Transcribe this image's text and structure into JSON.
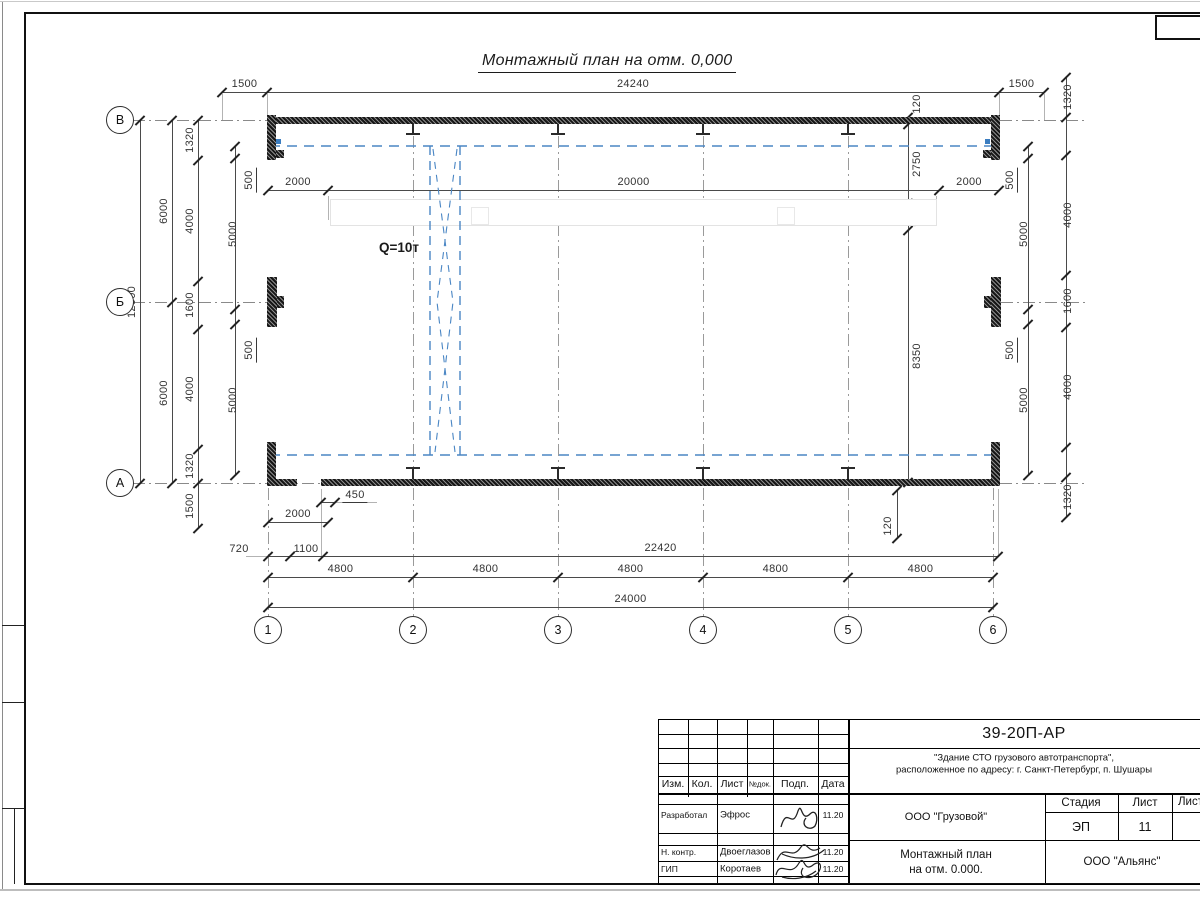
{
  "drawing": {
    "title": "Монтажный план на отм. 0,000",
    "crane_label": "Q=10т"
  },
  "axes": {
    "row_labels": [
      "В",
      "Б",
      "А"
    ],
    "row_x": 120,
    "row_ys": [
      120,
      302,
      483
    ],
    "col_labels": [
      "1",
      "2",
      "3",
      "4",
      "5",
      "6"
    ],
    "col_xs": [
      268,
      413,
      558,
      703,
      848,
      993
    ],
    "col_y": 630
  },
  "dims": {
    "h_chains": [
      {
        "y": 92,
        "pts": [
          222,
          267,
          999,
          1044
        ],
        "labels": [
          "1500",
          "24240",
          "1500"
        ]
      },
      {
        "y": 190,
        "pts": [
          268,
          328,
          939,
          999
        ],
        "labels": [
          "2000",
          "20000",
          "2000"
        ]
      },
      {
        "y": 502,
        "pts": [
          321,
          335
        ],
        "labels": [
          ""
        ]
      },
      {
        "y": 522,
        "pts": [
          268,
          328
        ],
        "labels": [
          "2000"
        ]
      },
      {
        "y": 556,
        "pts": [
          268,
          290,
          323,
          998
        ],
        "labels": [
          "",
          "",
          "22420"
        ]
      },
      {
        "y": 577,
        "pts": [
          268,
          413,
          558,
          703,
          848,
          993
        ],
        "labels": [
          "4800",
          "4800",
          "4800",
          "4800",
          "4800"
        ]
      },
      {
        "y": 607,
        "pts": [
          268,
          993
        ],
        "labels": [
          "24000"
        ]
      }
    ],
    "v_chains": [
      {
        "x": 140,
        "ls": -8,
        "pts": [
          120,
          483
        ],
        "labels": [
          "12000"
        ]
      },
      {
        "x": 172,
        "ls": -8,
        "pts": [
          120,
          302,
          483
        ],
        "labels": [
          "6000",
          "6000"
        ]
      },
      {
        "x": 198,
        "ls": -8,
        "pts": [
          120,
          160,
          281,
          329,
          449,
          483,
          528
        ],
        "labels": [
          "1320",
          "4000",
          "1600",
          "4000",
          "1320",
          "1500"
        ]
      },
      {
        "x": 235,
        "ls": -2,
        "pts": [
          146,
          158,
          309,
          324,
          475
        ],
        "labels": [
          "",
          "5000",
          "",
          "5000"
        ]
      },
      {
        "x": 1028,
        "ls": -4,
        "pts": [
          146,
          158,
          309,
          324,
          475
        ],
        "labels": [
          "",
          "5000",
          "",
          "5000"
        ]
      },
      {
        "x": 1066,
        "ls": 2,
        "pts": [
          77,
          117,
          155,
          275,
          327,
          447,
          477,
          517
        ],
        "labels": [
          "1320",
          "",
          "4000",
          "1600",
          "4000",
          "",
          "1320"
        ]
      },
      {
        "x": 908,
        "ls": 9,
        "pts": [
          117,
          124,
          203,
          230,
          482
        ],
        "labels": [
          "",
          "2750",
          "900",
          "8350"
        ]
      },
      {
        "x": 897,
        "ls": 0,
        "pts": [
          490,
          538
        ],
        "labels": [
          ""
        ]
      }
    ],
    "free_labels": [
      {
        "x": 355,
        "y": 496,
        "t": "450",
        "u": true
      },
      {
        "x": 239,
        "y": 549,
        "t": "720"
      },
      {
        "x": 306,
        "y": 549,
        "t": "1100"
      },
      {
        "x": 250,
        "y": 180,
        "t": "500",
        "r": true,
        "u": true
      },
      {
        "x": 250,
        "y": 350,
        "t": "500",
        "r": true,
        "u": true
      },
      {
        "x": 1011,
        "y": 180,
        "t": "500",
        "r": true,
        "u": true
      },
      {
        "x": 1011,
        "y": 350,
        "t": "500",
        "r": true,
        "u": true
      },
      {
        "x": 917,
        "y": 104,
        "t": "120",
        "r": true
      },
      {
        "x": 888,
        "y": 526,
        "t": "120",
        "r": true
      }
    ],
    "xlines": [
      {
        "x": 222,
        "y": 94,
        "h": 26
      },
      {
        "x": 267,
        "y": 94,
        "h": 21
      },
      {
        "x": 999,
        "y": 94,
        "h": 21
      },
      {
        "x": 1044,
        "y": 94,
        "h": 26
      },
      {
        "x": 321,
        "y": 489,
        "h": 67
      },
      {
        "x": 998,
        "y": 489,
        "h": 67
      },
      {
        "x": 246,
        "y": 556,
        "w": 22
      },
      {
        "x": 335,
        "y": 502,
        "w": 42
      },
      {
        "x": 936,
        "y": 196,
        "h": 24
      },
      {
        "x": 328,
        "y": 196,
        "h": 24
      }
    ],
    "gridlines": [
      {
        "x": 133,
        "y": 120,
        "w": 135
      },
      {
        "x": 133,
        "y": 302,
        "w": 134
      },
      {
        "x": 133,
        "y": 483,
        "w": 135
      },
      {
        "x": 1000,
        "y": 120,
        "w": 85
      },
      {
        "x": 1001,
        "y": 302,
        "w": 84
      },
      {
        "x": 1000,
        "y": 483,
        "w": 85
      },
      {
        "x": 280,
        "y": 483,
        "w": 40
      },
      {
        "x": 268,
        "y": 488,
        "h": 128
      },
      {
        "x": 993,
        "y": 488,
        "h": 128
      },
      {
        "x": 413,
        "y": 136,
        "h": 480
      },
      {
        "x": 558,
        "y": 136,
        "h": 480
      },
      {
        "x": 703,
        "y": 136,
        "h": 480
      },
      {
        "x": 848,
        "y": 136,
        "h": 480
      }
    ],
    "columns_x": [
      413,
      558,
      703,
      848
    ]
  },
  "title_block": {
    "doc_number": "39-20П-АР",
    "object_line1": "\"Здание СТО грузового автотранспорта\",",
    "object_line2": "расположенное по адресу: г. Санкт-Петербург, п. Шушары",
    "header_cols": [
      "Изм.",
      "Кол.",
      "Лист",
      "№док.",
      "Подп.",
      "Дата"
    ],
    "approval_rows": [
      {
        "role": "Разработал",
        "name": "Эфрос",
        "date": "11.20"
      },
      {
        "role": "Н. контр.",
        "name": "Двоеглазов",
        "date": "11.20"
      },
      {
        "role": "ГИП",
        "name": "Коротаев",
        "date": "11.20"
      }
    ],
    "client": "ООО \"Грузовой\"",
    "stage_label": "Стадия",
    "sheet_label": "Лист",
    "sheets_label": "Листов",
    "stage_value": "ЭП",
    "sheet_value": "11",
    "drawing_name_line1": "Монтажный план",
    "drawing_name_line2": "на отм. 0.000.",
    "contractor": "ООО \"Альянс\""
  }
}
